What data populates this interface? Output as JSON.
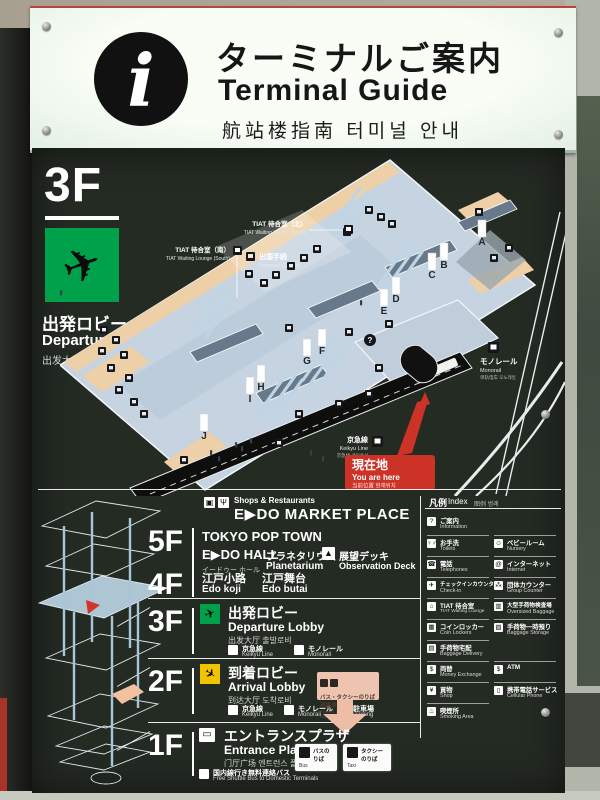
{
  "header": {
    "info_glyph": "i",
    "title_jp": "ターミナルご案内",
    "title_en": "Terminal Guide",
    "title_sub": "航站楼指南  터미널 안내"
  },
  "badge": {
    "floor": "3F",
    "plane_glyph": "✈",
    "jp": "出発ロビー",
    "en": "Departure Lobby",
    "sub": "出发大厅  출발로비"
  },
  "map": {
    "gates": [
      "A",
      "B",
      "C",
      "D",
      "E",
      "F",
      "G",
      "H",
      "I",
      "J"
    ],
    "question_glyph": "?",
    "tiat_north_jp": "TIAT 待合室（北）",
    "tiat_north_en": "TIAT Waiting Lounge (North)",
    "tiat_south_jp": "TIAT 待合室（南）",
    "tiat_south_en": "TIAT Waiting Lounge (South)",
    "passport_jp": "出国手続",
    "passport_en": "Passport Control",
    "keikyu_jp": "京急線",
    "keikyu_en": "Keikyu Line",
    "keikyu_sub": "京急线 게이큐선",
    "mono_jp": "モノレール",
    "mono_en": "Monorail",
    "mono_sub": "单轨电车 모노레일",
    "here_jp": "現在地",
    "here_en": "You are here",
    "here_sub": "当前位置 현재위치"
  },
  "f5": {
    "num": "5F",
    "shop_icon": "▣",
    "rest_icon": "Ψ",
    "shops_small": "Shops & Restaurants",
    "market": "E▶DO MARKET PLACE",
    "pop_town": "TOKYO POP TOWN",
    "edo_hall": "E▶DO HALL",
    "edo_hall_sub": "イードゥー ホール",
    "planetarium_jp": "プラネタリウム",
    "planetarium_en": "Planetarium",
    "deck_icon": "▲",
    "deck_jp": "展望デッキ",
    "deck_en": "Observation Deck"
  },
  "f4": {
    "num": "4F",
    "koji_jp": "江戸小路",
    "koji_en": "Edo koji",
    "butai_jp": "江戸舞台",
    "butai_en": "Edo butai"
  },
  "f3": {
    "num": "3F",
    "plane_glyph": "✈",
    "jp": "出発ロビー",
    "en": "Departure Lobby",
    "sub": "出发大厅  출발로비"
  },
  "f2": {
    "num": "2F",
    "plane_glyph": "✈",
    "jp": "到着ロビー",
    "en": "Arrival Lobby",
    "sub": "到达大厅  도착로비",
    "parking_icon": "P",
    "parking_jp": "駐車場",
    "parking_en": "Parking",
    "connector_jp": "バス・タクシーのりば 連絡通路",
    "connector_en": "Access to bus and taxi stands"
  },
  "f1": {
    "num": "1F",
    "bus_icon": "▭",
    "jp": "エントランスプラザ",
    "en": "Entrance Plaza",
    "sub": "门厅广场  엔트런스 플라자",
    "shuttle_jp": "国内線行き無料連絡バス",
    "shuttle_en": "Free Shuttle Bus to Domestic Terminals",
    "bus_box_jp": "バスのりば",
    "bus_box_en": "Bus",
    "taxi_box_jp": "タクシーのりば",
    "taxi_box_en": "Taxi"
  },
  "legend": {
    "title_jp": "凡例",
    "title_en": "Index",
    "title_sub": "图例  범례",
    "left": [
      {
        "icon": "?",
        "jp": "ご案内",
        "en": "Information"
      },
      {
        "icon": "♀♂",
        "jp": "お手洗",
        "en": "Toilets"
      },
      {
        "icon": "☎",
        "jp": "電話",
        "en": "Telephones"
      },
      {
        "icon": "✈",
        "jp": "チェックインカウンター",
        "en": "Check-in"
      },
      {
        "icon": "⌂",
        "jp": "TIAT 待合室",
        "en": "TIAT Waiting Lounge"
      },
      {
        "icon": "▦",
        "jp": "コインロッカー",
        "en": "Coin Lockers"
      },
      {
        "icon": "▤",
        "jp": "手荷物宅配",
        "en": "Baggage Delivery"
      },
      {
        "icon": "$",
        "jp": "両替",
        "en": "Money Exchange"
      },
      {
        "icon": "¥",
        "jp": "買物",
        "en": "Shop"
      },
      {
        "icon": "♨",
        "jp": "喫煙所",
        "en": "Smoking Area"
      }
    ],
    "right": [
      {
        "icon": "☺",
        "jp": "ベビールーム",
        "en": "Nursery"
      },
      {
        "icon": "@",
        "jp": "インターネット",
        "en": "Internet"
      },
      {
        "icon": "⁂",
        "jp": "団体カウンター",
        "en": "Group Counter"
      },
      {
        "icon": "▥",
        "jp": "大型手荷物検査場",
        "en": "Oversized Baggage"
      },
      {
        "icon": "▧",
        "jp": "手荷物一時預り",
        "en": "Baggage Storage"
      },
      {
        "icon": "$",
        "jp": "ATM",
        "en": ""
      },
      {
        "icon": "▯",
        "jp": "携帯電話サービス",
        "en": "Cellular Phone"
      }
    ]
  }
}
